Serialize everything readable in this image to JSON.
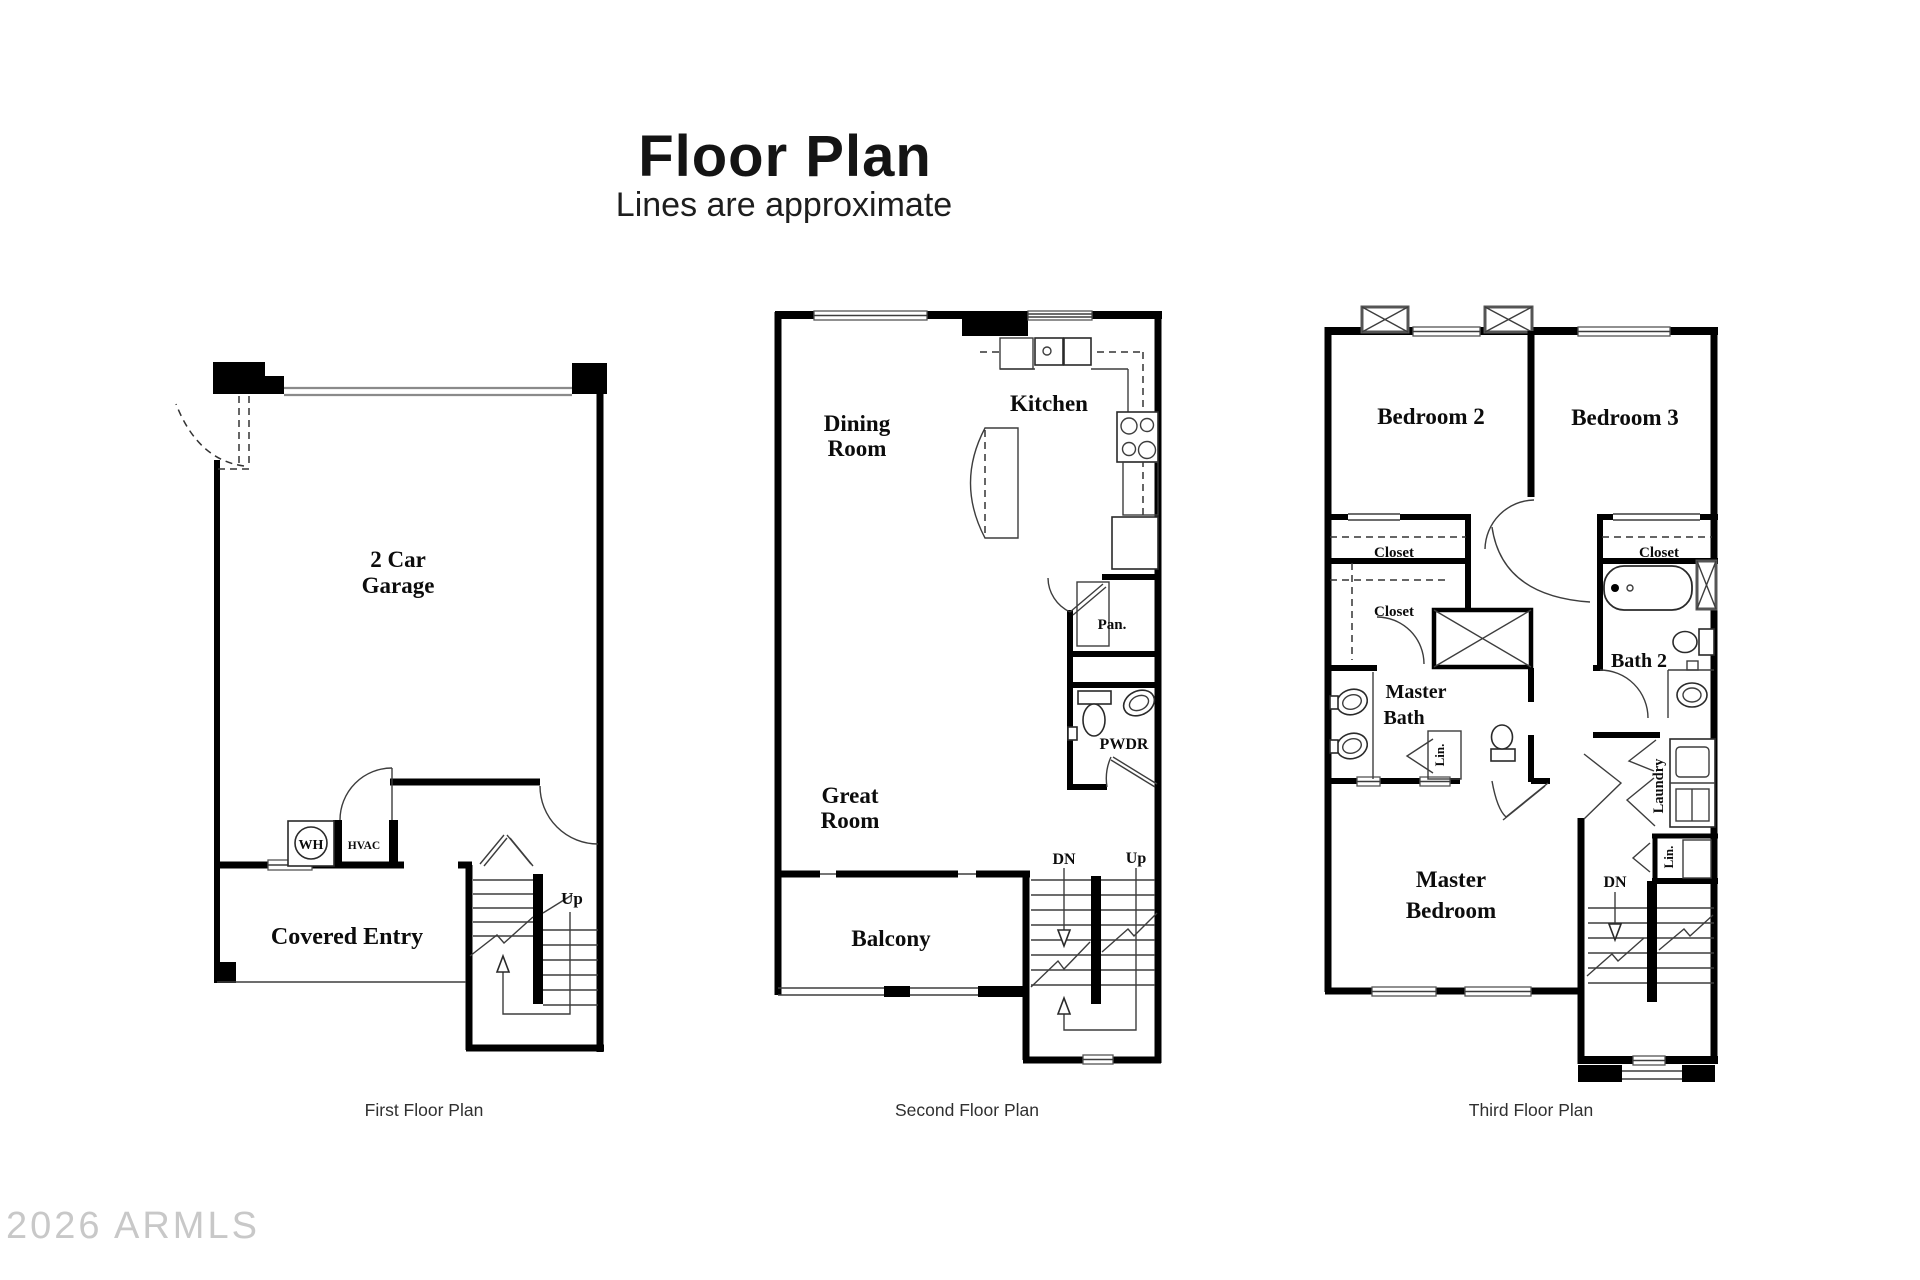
{
  "title": "Floor Plan",
  "subtitle": "Lines are approximate",
  "watermark": "2026 ARMLS",
  "first_floor": {
    "caption": "First Floor Plan",
    "garage_line1": "2 Car",
    "garage_line2": "Garage",
    "water_heater": "WH",
    "hvac": "HVAC",
    "covered_entry": "Covered Entry",
    "up": "Up"
  },
  "second_floor": {
    "caption": "Second Floor Plan",
    "dining_line1": "Dining",
    "dining_line2": "Room",
    "kitchen": "Kitchen",
    "pantry": "Pan.",
    "powder": "PWDR",
    "great_line1": "Great",
    "great_line2": "Room",
    "balcony": "Balcony",
    "down": "DN",
    "up": "Up"
  },
  "third_floor": {
    "caption": "Third Floor Plan",
    "bedroom2": "Bedroom 2",
    "bedroom3": "Bedroom 3",
    "closet1": "Closet",
    "closet2": "Closet",
    "closet3": "Closet",
    "master_bath_line1": "Master",
    "master_bath_line2": "Bath",
    "bath2": "Bath 2",
    "linen1": "Lin.",
    "laundry": "Laundry",
    "linen2": "Lin.",
    "master_bed_line1": "Master",
    "master_bed_line2": "Bedroom",
    "down": "DN"
  }
}
